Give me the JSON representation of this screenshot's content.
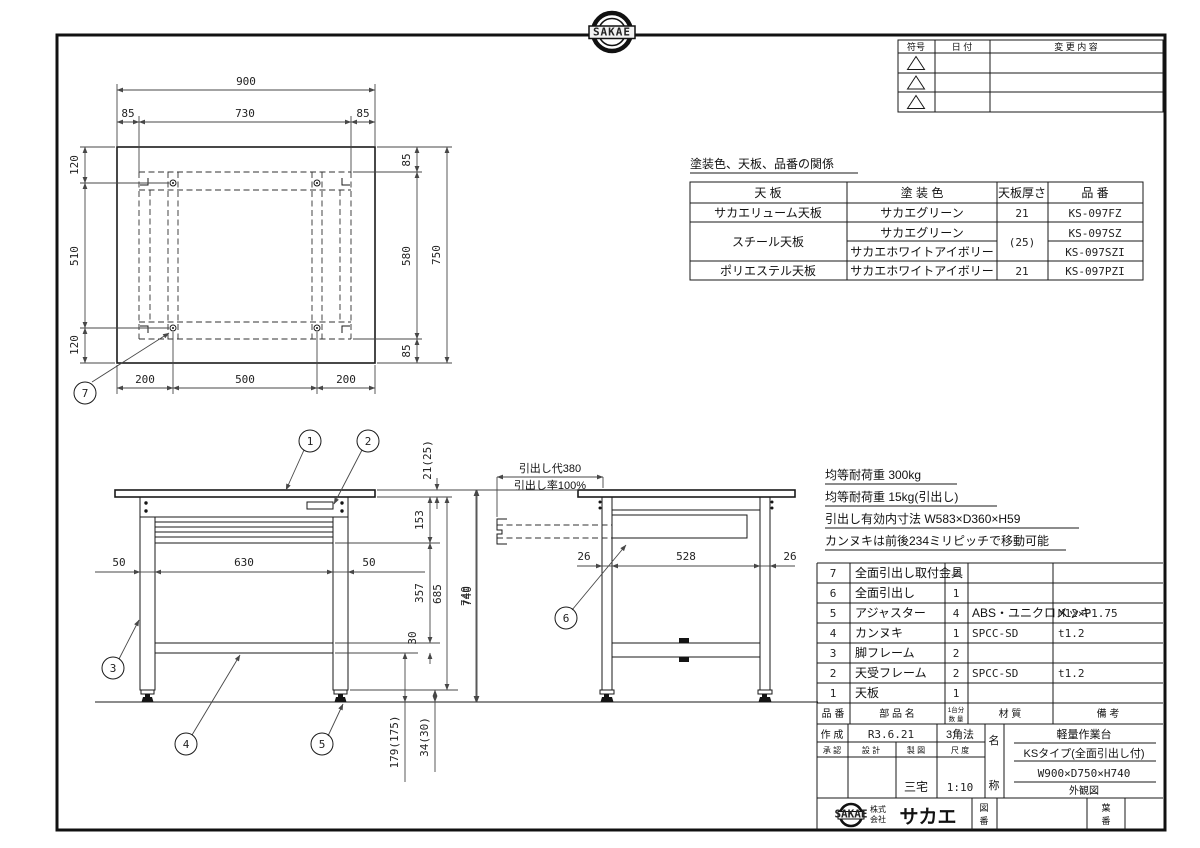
{
  "sheet": {
    "bg": "#ffffff",
    "line_color": "#1a1a1a",
    "dim_color": "#474747"
  },
  "stamp": {
    "logo": "SAKAE"
  },
  "revision_table": {
    "col_symbol": "符号",
    "col_date": "日  付",
    "col_change": "変  更  内  容"
  },
  "paint_table": {
    "title": "塗装色、天板、品番の関係",
    "h_top": "天  板",
    "h_color": "塗  装  色",
    "h_thickness": "天板厚さ",
    "h_part_no": "品  番",
    "r1_top": "サカエリューム天板",
    "r1_color": "サカエグリーン",
    "r1_thickness": "21",
    "r1_part": "KS-097FZ",
    "r2_top": "スチール天板",
    "r2_color_a": "サカエグリーン",
    "r2_color_b": "サカエホワイトアイボリー",
    "r2_thickness": "(25)",
    "r2_part_a": "KS-097SZ",
    "r2_part_b": "KS-097SZI",
    "r3_top": "ポリエステル天板",
    "r3_color": "サカエホワイトアイボリー",
    "r3_thickness": "21",
    "r3_part": "KS-097PZI"
  },
  "notes": {
    "line1": "均等耐荷重 300kg",
    "line2": "均等耐荷重 15kg(引出し)",
    "line3": "引出し有効内寸法 W583×D360×H59",
    "line4": "カンヌキは前後234ミリピッチで移動可能"
  },
  "plan_view": {
    "dim_900": "900",
    "dim_85l": "85",
    "dim_730": "730",
    "dim_85r": "85",
    "dim_120t": "120",
    "dim_510": "510",
    "dim_120b": "120",
    "dim_85t": "85",
    "dim_580": "580",
    "dim_85b": "85",
    "dim_750": "750",
    "dim_200l": "200",
    "dim_500": "500",
    "dim_200r": "200",
    "balloon_7": "7"
  },
  "front_view": {
    "dim_50l": "50",
    "dim_630": "630",
    "dim_50r": "50",
    "dim_21": "21(25)",
    "dim_153": "153",
    "dim_357": "357",
    "dim_30": "30",
    "dim_685": "685",
    "dim_740": "740",
    "dim_179": "179(175)",
    "dim_34": "34(30)",
    "balloon_1": "1",
    "balloon_2": "2",
    "balloon_3": "3",
    "balloon_4": "4",
    "balloon_5": "5"
  },
  "side_view": {
    "note_stroke": "引出し代380",
    "note_rate": "引出し率100%",
    "dim_740": "740",
    "dim_26l": "26",
    "dim_528": "528",
    "dim_26r": "26",
    "balloon_6": "6"
  },
  "parts_table": {
    "h_no": "品 番",
    "h_name": "部 品 名",
    "h_qty1": "1台分",
    "h_qty2": "数 量",
    "h_material": "材    質",
    "h_remarks": "備    考",
    "rows": [
      {
        "no": "7",
        "name": "全面引出し取付金具",
        "qty": "2",
        "material": "",
        "remarks": ""
      },
      {
        "no": "6",
        "name": "全面引出し",
        "qty": "1",
        "material": "",
        "remarks": ""
      },
      {
        "no": "5",
        "name": "アジャスター",
        "qty": "4",
        "material": "ABS・ユニクロメッキ",
        "remarks": "M12×P1.75"
      },
      {
        "no": "4",
        "name": "カンヌキ",
        "qty": "1",
        "material": "SPCC-SD",
        "remarks": "t1.2"
      },
      {
        "no": "3",
        "name": "脚フレーム",
        "qty": "2",
        "material": "",
        "remarks": ""
      },
      {
        "no": "2",
        "name": "天受フレーム",
        "qty": "2",
        "material": "SPCC-SD",
        "remarks": "t1.2"
      },
      {
        "no": "1",
        "name": "天板",
        "qty": "1",
        "material": "",
        "remarks": ""
      }
    ]
  },
  "title_block": {
    "created_label": "作 成",
    "created_date": "R3.6.21",
    "projection": "3角法",
    "approved_label": "承 認",
    "design_label": "設 計",
    "draft_label": "製 図",
    "scale_label": "尺 度",
    "draft_name": "三宅",
    "scale_value": "1:10",
    "name_char1": "名",
    "name_char2": "称",
    "product_name": "軽量作業台",
    "product_type": "KSタイプ(全面引出し付)",
    "product_size": "W900×D750×H740",
    "drawing_kind": "外観図",
    "company_line1": "株式",
    "company_line2": "会社",
    "company_name": "サカエ",
    "fig_char1": "図",
    "fig_char2": "番",
    "sheet_char1": "葉",
    "sheet_char2": "番"
  }
}
